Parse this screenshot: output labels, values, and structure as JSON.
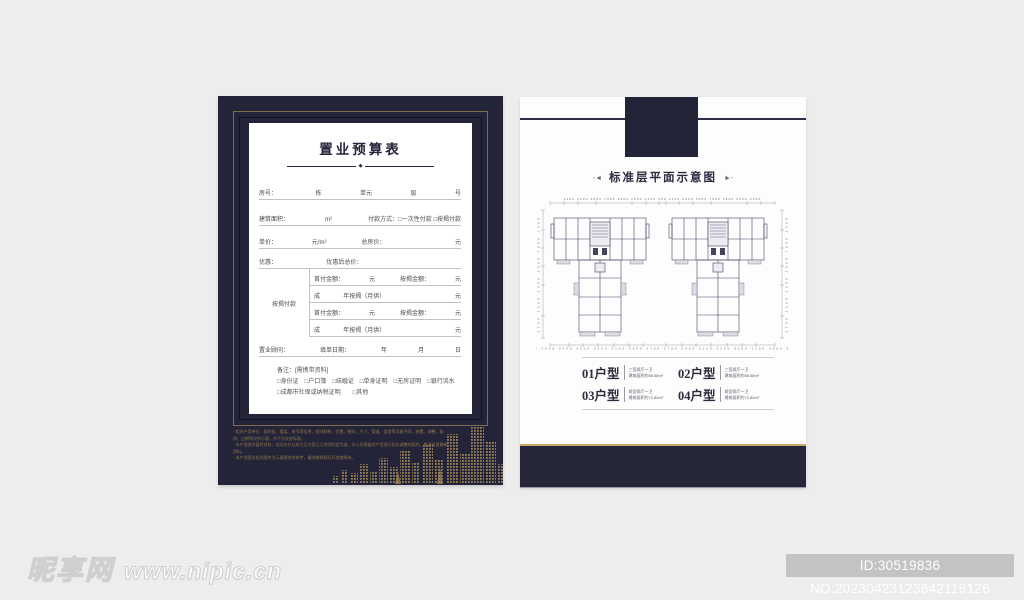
{
  "colors": {
    "panel_navy": "#242438",
    "frame_gold": "#7e6d4f",
    "accent_gold": "#c9a868",
    "skyline_gold": "#9a8155",
    "paper_white": "#ffffff"
  },
  "left_panel": {
    "paper": {
      "title": "置业预算表",
      "divider_diamond": "◆",
      "form": {
        "row1": {
          "l": "房号：",
          "a": "栋",
          "b": "单元",
          "c": "层",
          "d": "号"
        },
        "row2": {
          "l": "建筑面积：",
          "a": "m²",
          "b": "付款方式：□一次性付款 □按揭付款"
        },
        "row3": {
          "l": "单价：",
          "a": "元/m²",
          "b": "总房价：",
          "c": "元"
        },
        "row4": {
          "l": "优惠：",
          "a": "优惠后总价："
        },
        "mortgage_label": "按揭付款",
        "m1": {
          "l": "首付金额：",
          "a": "元",
          "b": "按揭金额：",
          "c": "元"
        },
        "m2": {
          "l": "成",
          "a": "年按揭（月供）",
          "b": "元"
        },
        "m3": {
          "l": "首付金额：",
          "a": "元",
          "b": "按揭金额：",
          "c": "元"
        },
        "m4": {
          "l": "成",
          "a": "年按揭（月供）",
          "b": "元"
        },
        "row5": {
          "l": "置业顾问：",
          "a": "填单日期：",
          "b": "年",
          "c": "月",
          "d": "日"
        }
      },
      "note_title": "备注：[需携带资料]",
      "checkline1": "□身份证　□户口簿　□结婚证　□单身证明　□无房证明　□银行流水",
      "checkline2": "□成都市社保或纳税证明　　□其他"
    },
    "disclaimer": [
      "相关户型单位、面积段、楼层、房号等信息，相邻结构、位置、朝向、尺寸、管道、造型等可能不同，装置、调整、取消、过期等仅供示意，并不为交房标准。",
      "本户型图为暂时资料，实际交付以双方正式签订之合同约定为准，本公司保留对户型进行优化调整的权利，敬请留意最新资料。",
      "本户型图及相关图件为示意图仅供参考，最终解释权归开发商所有。"
    ]
  },
  "right_panel": {
    "title": "标准层平面示意图",
    "orn_left": "-◄",
    "orn_right": "►-",
    "plan": {
      "dims_top": "2400 2600 3600 7300 3600 2600 2400 600 2400 2600 3600 7300 3600 2600 2400",
      "dims_bottom": "3700 2600 3100 3200 3200 3100 2600 3700  3700 2600 3100 3200 3200 3100 2600 3700",
      "dims_left": "2700 2300 2600 2900 7900 2400",
      "dims_right": "2700 2300 2600 2900 7900 2400"
    },
    "units": [
      {
        "no": "01户型",
        "rooms": "三室两厅一卫",
        "area": "建筑面积约88.58m²"
      },
      {
        "no": "02户型",
        "rooms": "三室两厅一卫",
        "area": "建筑面积约88.58m²"
      },
      {
        "no": "03户型",
        "rooms": "两室两厅一卫",
        "area": "建筑面积约72.82m²"
      },
      {
        "no": "04户型",
        "rooms": "两室两厅一卫",
        "area": "建筑面积约72.82m²"
      }
    ]
  },
  "watermark": {
    "site": "昵享网",
    "url": "www.nipic.cn"
  },
  "id_badge": {
    "text": "ID:30519836 NO:20230423123642119126"
  }
}
